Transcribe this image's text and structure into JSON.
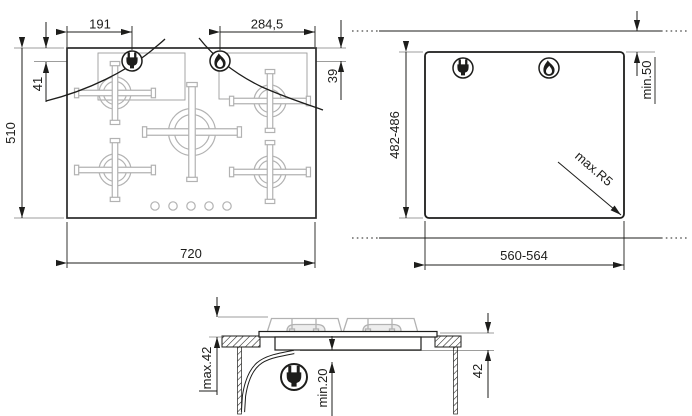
{
  "drawing": {
    "type": "installation-diagram",
    "product": "5-burner gas hob",
    "views": {
      "top": {
        "width": "720",
        "depth": "510",
        "electric_offset_x": "191",
        "gas_offset_x": "284,5",
        "electric_offset_y": "41",
        "gas_offset_y": "39"
      },
      "cutout": {
        "width": "560-564",
        "depth": "482-486",
        "rear_clearance": "min.50",
        "corner_radius": "max.R5"
      },
      "side": {
        "height_above_worktop": "max.42",
        "height_below_worktop": "42",
        "clearance_below": "min.20"
      }
    },
    "icons": {
      "electric": "plug",
      "gas": "flame"
    },
    "colors": {
      "line": "#1d1d1b",
      "reference": "#9d9d9c",
      "light": "#b2b2b2"
    }
  }
}
